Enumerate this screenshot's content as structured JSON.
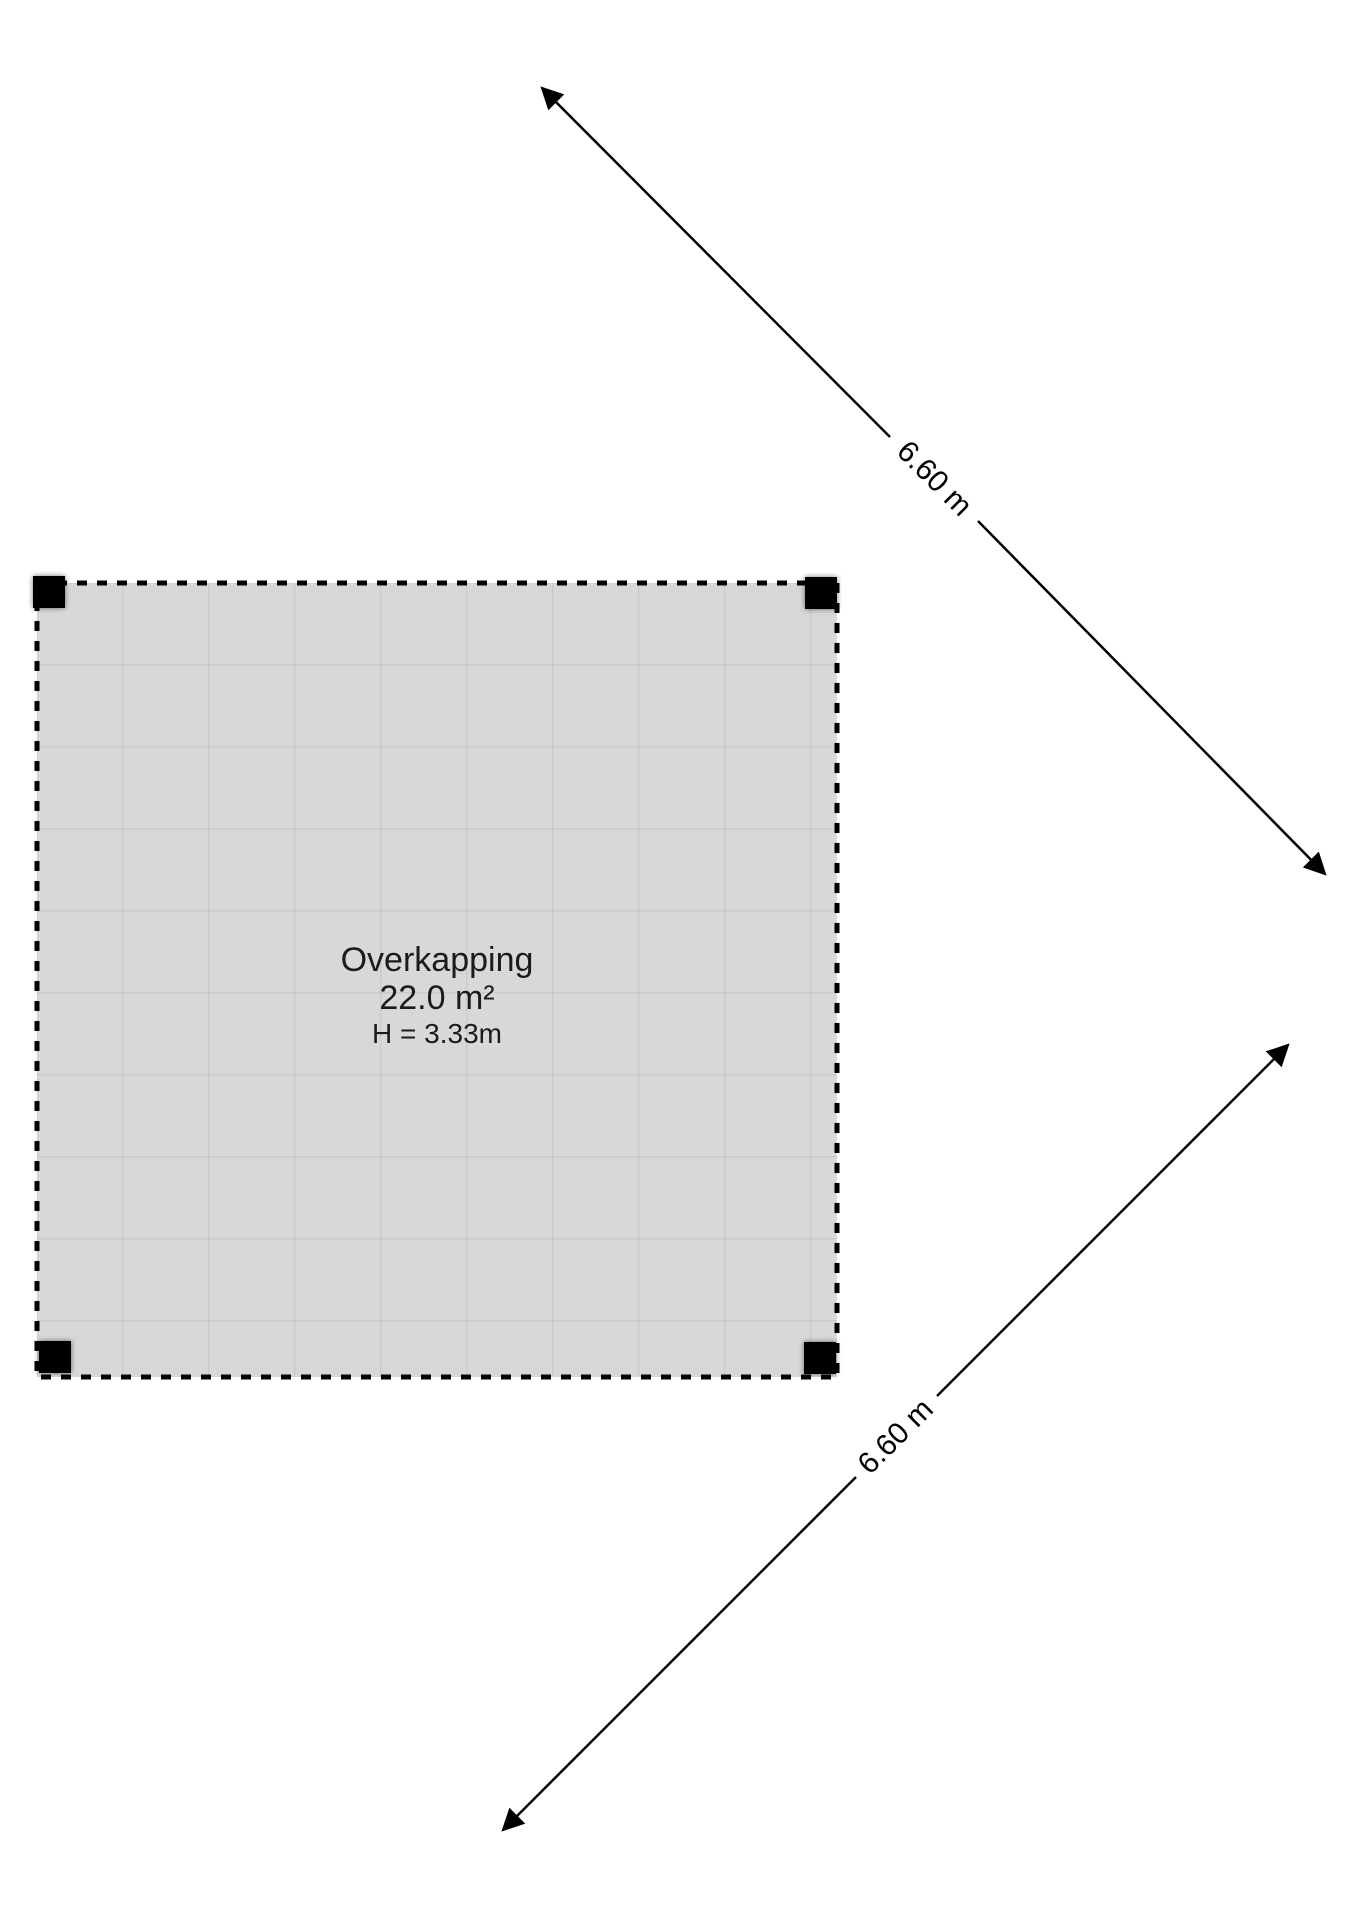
{
  "structure": {
    "name": "Overkapping",
    "area": "22.0 m²",
    "height_label": "H = 3.33m"
  },
  "dimensions": {
    "top_diagonal": {
      "label": "6.60 m"
    },
    "bottom_diagonal": {
      "label": "6.60 m"
    }
  },
  "posts": [
    "top-left",
    "top-right",
    "bottom-left",
    "bottom-right"
  ],
  "colors": {
    "background": "#ffffff",
    "floor_fill": "#d8d8d8",
    "grid_line": "#c9c9c9",
    "outline": "#000000",
    "post": "#000000",
    "text": "#1b1b1b"
  }
}
